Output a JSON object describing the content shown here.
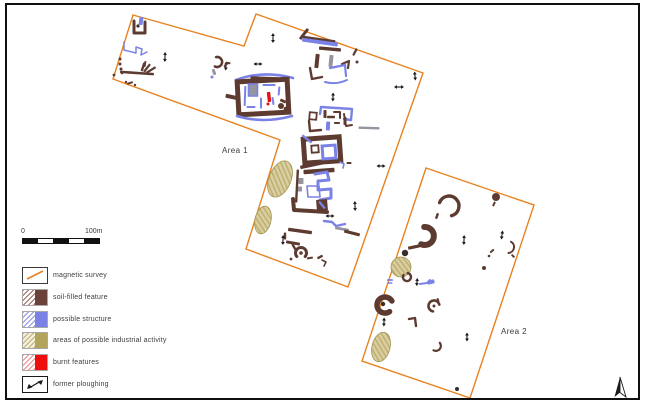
{
  "canvas": {
    "width": 646,
    "height": 407,
    "background": "#ffffff",
    "frame_color": "#0f0f0f"
  },
  "colors": {
    "orange": "#E8821E",
    "brown": "#5E3B31",
    "blue": "#7B82E6",
    "grey": "#9595A0",
    "red": "#E41111",
    "dark": "#3A2C28",
    "khaki": "#C9BB87",
    "khakiDark": "#A3924F",
    "black": "#1A1A1A",
    "text": "#3C3C3C"
  },
  "scalebar": {
    "start_label": "0",
    "end_label": "100m",
    "segments": 5
  },
  "legend": {
    "items": [
      {
        "id": "magnetic-survey",
        "label": "magnetic survey"
      },
      {
        "id": "soil-filled-feature",
        "label": "soil-filled feature"
      },
      {
        "id": "possible-structure",
        "label": "possible structure"
      },
      {
        "id": "industrial-activity",
        "label": "areas of possible industrial activity"
      },
      {
        "id": "burnt-features",
        "label": "burnt features"
      },
      {
        "id": "former-ploughing",
        "label": "former ploughing"
      }
    ]
  },
  "map": {
    "areas": [
      {
        "id": "1",
        "label": "Area 1",
        "label_x": 235,
        "label_y": 153,
        "points": "133,15 244,46 256,14 423,73 348,287 246,249 280,140 113,79"
      },
      {
        "id": "2",
        "label": "Area 2",
        "label_x": 514,
        "label_y": 334,
        "points": "426,168 534,205 470,398 362,361"
      }
    ],
    "north_arrow": {
      "x": 620,
      "y": 387
    },
    "features": [
      {
        "t": "poly",
        "p": "134,21 134,33 145,33 145,22",
        "c": "brown",
        "w": 3
      },
      {
        "t": "bar",
        "x": 141,
        "y": 21,
        "w": 4,
        "h": 8,
        "r": 8,
        "c": "blue"
      },
      {
        "t": "dot",
        "x": 138,
        "y": 26,
        "rad": 1.6,
        "c": "dark"
      },
      {
        "t": "poly",
        "p": "124,42 124,50 136,53 136,47 142,49 141,55 147,52",
        "c": "blue",
        "w": 1.5
      },
      {
        "t": "arrow",
        "x": 165,
        "y": 57,
        "l": 10,
        "r": 92
      },
      {
        "t": "dot",
        "x": 120,
        "y": 59,
        "rad": 1.5,
        "c": "brown"
      },
      {
        "t": "dot",
        "x": 120,
        "y": 64,
        "rad": 1.5,
        "c": "brown"
      },
      {
        "t": "dot",
        "x": 121,
        "y": 69,
        "rad": 1.5,
        "c": "brown"
      },
      {
        "t": "dot",
        "x": 122,
        "y": 73,
        "rad": 1.3,
        "c": "brown"
      },
      {
        "t": "bar",
        "x": 137,
        "y": 73,
        "w": 34,
        "h": 2.6,
        "r": 4,
        "c": "brown"
      },
      {
        "t": "bar",
        "x": 143,
        "y": 67,
        "w": 2.4,
        "h": 9,
        "r": 18,
        "c": "brown"
      },
      {
        "t": "bar",
        "x": 147,
        "y": 68,
        "w": 2.2,
        "h": 10,
        "r": 38,
        "c": "brown"
      },
      {
        "t": "bar",
        "x": 151,
        "y": 70,
        "w": 2.2,
        "h": 11,
        "r": 58,
        "c": "brown"
      },
      {
        "t": "bar",
        "x": 145,
        "y": 64,
        "w": 2,
        "h": 6,
        "r": 10,
        "c": "brown"
      },
      {
        "t": "dot",
        "x": 114,
        "y": 75,
        "rad": 1.4,
        "c": "brown"
      },
      {
        "t": "bar",
        "x": 130,
        "y": 83,
        "w": 6,
        "h": 2,
        "r": -18,
        "c": "brown"
      },
      {
        "t": "dot",
        "x": 135,
        "y": 85,
        "rad": 1.2,
        "c": "brown"
      },
      {
        "t": "dot",
        "x": 126,
        "y": 82,
        "rad": 1.2,
        "c": "brown"
      },
      {
        "t": "carc",
        "x": 217,
        "y": 62,
        "rad": 5,
        "a1": -100,
        "a2": 115,
        "w": 2.6,
        "c": "brown"
      },
      {
        "t": "bar",
        "x": 214,
        "y": 72,
        "w": 3,
        "h": 6,
        "r": -20,
        "c": "grey"
      },
      {
        "t": "dot",
        "x": 212,
        "y": 77,
        "rad": 1.5,
        "c": "blue"
      },
      {
        "t": "arrow",
        "x": 226,
        "y": 66,
        "l": 9,
        "r": 95
      },
      {
        "t": "arrow",
        "x": 273,
        "y": 38,
        "l": 10,
        "r": 90
      },
      {
        "t": "qarc",
        "p": [
          236,
          80,
          263,
          70,
          293,
          78
        ],
        "w": 2.6,
        "c": "blue"
      },
      {
        "t": "bar",
        "x": 264,
        "y": 79,
        "w": 27,
        "h": 4.6,
        "r": 2,
        "c": "brown"
      },
      {
        "t": "rbox",
        "x": 263,
        "y": 97,
        "w": 50,
        "h": 33,
        "r": -3,
        "sw": 5,
        "c": "brown"
      },
      {
        "t": "bar",
        "x": 232,
        "y": 97,
        "w": 13,
        "h": 4,
        "r": 12,
        "c": "brown"
      },
      {
        "t": "bar",
        "x": 253,
        "y": 90,
        "w": 9,
        "h": 12,
        "r": 0,
        "c": "grey"
      },
      {
        "t": "rbox",
        "x": 253,
        "y": 90,
        "w": 9,
        "h": 12,
        "r": 0,
        "sw": 1.6,
        "c": "blue"
      },
      {
        "t": "bar",
        "x": 245,
        "y": 96,
        "w": 2,
        "h": 20,
        "r": 2,
        "c": "blue"
      },
      {
        "t": "bar",
        "x": 261,
        "y": 103,
        "w": 2,
        "h": 11,
        "r": 0,
        "c": "blue"
      },
      {
        "t": "bar",
        "x": 269,
        "y": 85,
        "w": 13,
        "h": 2,
        "r": 0,
        "c": "blue"
      },
      {
        "t": "bar",
        "x": 279,
        "y": 91,
        "w": 2,
        "h": 9,
        "r": 5,
        "c": "blue"
      },
      {
        "t": "bar",
        "x": 273,
        "y": 101,
        "w": 2,
        "h": 8,
        "r": -8,
        "c": "blue"
      },
      {
        "t": "bar",
        "x": 251,
        "y": 107,
        "w": 9,
        "h": 2,
        "r": 0,
        "c": "blue"
      },
      {
        "t": "bar",
        "x": 269,
        "y": 97,
        "w": 3.4,
        "h": 10,
        "r": -6,
        "c": "red"
      },
      {
        "t": "dot",
        "x": 268,
        "y": 104,
        "rad": 1.5,
        "c": "red"
      },
      {
        "t": "dot",
        "x": 281,
        "y": 106,
        "rad": 3,
        "c": "brown"
      },
      {
        "t": "dot",
        "x": 286,
        "y": 109,
        "rad": 2.4,
        "c": "brown"
      },
      {
        "t": "bar",
        "x": 283,
        "y": 101,
        "w": 6,
        "h": 3,
        "r": 25,
        "c": "brown"
      },
      {
        "t": "qarc",
        "p": [
          237,
          116,
          263,
          124,
          292,
          116
        ],
        "w": 2.6,
        "c": "blue"
      },
      {
        "t": "bar",
        "x": 228,
        "y": 63,
        "w": 5,
        "h": 2,
        "r": 10,
        "c": "brown"
      },
      {
        "t": "dot",
        "x": 225,
        "y": 66,
        "rad": 1.3,
        "c": "brown"
      },
      {
        "t": "arrow",
        "x": 258,
        "y": 64,
        "l": 9,
        "r": 0
      },
      {
        "t": "arrow",
        "x": 399,
        "y": 87,
        "l": 10,
        "r": 0
      },
      {
        "t": "arrow",
        "x": 415,
        "y": 76,
        "l": 9,
        "r": 85
      },
      {
        "t": "bar",
        "x": 304,
        "y": 34,
        "w": 3,
        "h": 13,
        "r": 38,
        "c": "brown"
      },
      {
        "t": "bar",
        "x": 320,
        "y": 42,
        "w": 36,
        "h": 4.2,
        "r": 8,
        "c": "blue"
      },
      {
        "t": "bar",
        "x": 319,
        "y": 39,
        "w": 33,
        "h": 2.2,
        "r": 8,
        "c": "brown"
      },
      {
        "t": "bar",
        "x": 330,
        "y": 49,
        "w": 22,
        "h": 3.4,
        "r": 5,
        "c": "brown"
      },
      {
        "t": "bar",
        "x": 317,
        "y": 61,
        "w": 4,
        "h": 14,
        "r": 6,
        "c": "brown"
      },
      {
        "t": "bar",
        "x": 331,
        "y": 61,
        "w": 4,
        "h": 12,
        "r": 6,
        "c": "grey"
      },
      {
        "t": "poly",
        "p": "342,64 349,61 348,68",
        "c": "brown",
        "w": 2.2
      },
      {
        "t": "bar",
        "x": 355,
        "y": 52,
        "w": 2.2,
        "h": 8,
        "r": 28,
        "c": "brown"
      },
      {
        "t": "dot",
        "x": 357,
        "y": 62,
        "rad": 1.5,
        "c": "brown"
      },
      {
        "t": "poly",
        "p": "330,68 345,65 346,76",
        "c": "blue",
        "w": 2.2
      },
      {
        "t": "poly",
        "p": "310,68 312,79 322,77",
        "c": "brown",
        "w": 2.4
      },
      {
        "t": "qarc",
        "p": [
          325,
          82,
          336,
          85,
          347,
          80
        ],
        "w": 2,
        "c": "blue"
      },
      {
        "t": "arrow",
        "x": 333,
        "y": 97,
        "l": 9,
        "r": 92
      },
      {
        "t": "poly",
        "p": "320,114 321,107 352,109 351,120 344,119",
        "c": "blue",
        "w": 2.4
      },
      {
        "t": "rbox",
        "x": 313,
        "y": 116,
        "w": 7,
        "h": 7,
        "r": 5,
        "sw": 1.8,
        "c": "brown"
      },
      {
        "t": "bar",
        "x": 325,
        "y": 114,
        "w": 3,
        "h": 8,
        "r": 0,
        "c": "brown"
      },
      {
        "t": "bar",
        "x": 331,
        "y": 117,
        "w": 8,
        "h": 2.4,
        "r": 0,
        "c": "brown"
      },
      {
        "t": "poly",
        "p": "334,112 340,112 340,118",
        "c": "brown",
        "w": 2
      },
      {
        "t": "bar",
        "x": 345,
        "y": 121,
        "w": 3,
        "h": 8,
        "r": 0,
        "c": "brown"
      },
      {
        "t": "bar",
        "x": 337,
        "y": 123,
        "w": 6,
        "h": 2,
        "r": 0,
        "c": "brown"
      },
      {
        "t": "poly",
        "p": "309,121 310,131 321,130",
        "c": "brown",
        "w": 2.4
      },
      {
        "t": "bar",
        "x": 328,
        "y": 126,
        "w": 4,
        "h": 9,
        "r": 3,
        "c": "blue"
      },
      {
        "t": "poly",
        "p": "344,114 346,126 352,125",
        "c": "brown",
        "w": 2
      },
      {
        "t": "bar",
        "x": 369,
        "y": 128,
        "w": 21,
        "h": 2.4,
        "r": 2,
        "c": "grey"
      },
      {
        "t": "rbox",
        "x": 322,
        "y": 150,
        "w": 36,
        "h": 24,
        "r": -4,
        "sw": 5,
        "c": "brown"
      },
      {
        "t": "rbox",
        "x": 329,
        "y": 152,
        "w": 13,
        "h": 13,
        "r": -4,
        "sw": 3,
        "c": "blue"
      },
      {
        "t": "bar",
        "x": 307,
        "y": 139,
        "w": 2.4,
        "h": 12,
        "r": -52,
        "c": "blue"
      },
      {
        "t": "rbox",
        "x": 315,
        "y": 149,
        "w": 7,
        "h": 7,
        "r": -4,
        "sw": 1.8,
        "c": "brown"
      },
      {
        "t": "bar",
        "x": 312,
        "y": 165,
        "w": 24,
        "h": 3.4,
        "r": -12,
        "c": "brown"
      },
      {
        "t": "poly",
        "p": "340,162 344,164 343,168",
        "c": "blue",
        "w": 1.6
      },
      {
        "t": "bar",
        "x": 349,
        "y": 163,
        "w": 5,
        "h": 2,
        "r": 0,
        "c": "brown"
      },
      {
        "t": "arrow",
        "x": 381,
        "y": 166,
        "l": 9,
        "r": 0
      },
      {
        "t": "bar",
        "x": 319,
        "y": 171,
        "w": 31,
        "h": 4.4,
        "r": -4,
        "c": "brown"
      },
      {
        "t": "bar",
        "x": 297,
        "y": 186,
        "w": 2.4,
        "h": 33,
        "r": 3,
        "c": "brown"
      },
      {
        "t": "bar",
        "x": 301,
        "y": 181,
        "w": 5,
        "h": 6,
        "r": 0,
        "c": "grey"
      },
      {
        "t": "bar",
        "x": 300,
        "y": 189,
        "w": 4,
        "h": 5,
        "r": 0,
        "c": "grey"
      },
      {
        "t": "poly",
        "p": "315,174 327,172 329,180 318,181 318,190 331,189 331,198 320,200",
        "c": "blue",
        "w": 3
      },
      {
        "t": "poly",
        "p": "307,186 319,186 320,197 308,197 307,186",
        "c": "blue",
        "w": 1.6
      },
      {
        "t": "poly",
        "p": "293,199 294,210 327,212",
        "c": "brown",
        "w": 4
      },
      {
        "t": "bar",
        "x": 322,
        "y": 205,
        "w": 11,
        "h": 11,
        "r": -5,
        "c": "brown"
      },
      {
        "t": "bar",
        "x": 322,
        "y": 205,
        "w": 2.4,
        "h": 9,
        "r": -40,
        "c": "blue"
      },
      {
        "t": "arrow",
        "x": 355,
        "y": 206,
        "l": 10,
        "r": 88
      },
      {
        "t": "arrow",
        "x": 330,
        "y": 216,
        "l": 9,
        "r": 0
      },
      {
        "t": "poly",
        "p": "324,221 332,222 336,226 345,224",
        "c": "blue",
        "w": 2.4
      },
      {
        "t": "bar",
        "x": 342,
        "y": 229,
        "w": 14,
        "h": 2.8,
        "r": 10,
        "c": "grey"
      },
      {
        "t": "bar",
        "x": 352,
        "y": 233,
        "w": 16,
        "h": 3.2,
        "r": 14,
        "c": "brown"
      },
      {
        "t": "bar",
        "x": 300,
        "y": 231,
        "w": 24,
        "h": 3.4,
        "r": 8,
        "c": "brown"
      },
      {
        "t": "bar",
        "x": 293,
        "y": 243,
        "w": 14,
        "h": 3,
        "r": 10,
        "c": "brown"
      },
      {
        "t": "bar",
        "x": 285,
        "y": 236,
        "w": 2.4,
        "h": 7,
        "r": 0,
        "c": "brown"
      },
      {
        "t": "arrow",
        "x": 283,
        "y": 240,
        "l": 10,
        "r": 92
      },
      {
        "t": "carc",
        "x": 301,
        "y": 253,
        "rad": 5.5,
        "a1": 140,
        "a2": 400,
        "w": 3,
        "c": "brown"
      },
      {
        "t": "dot",
        "x": 301,
        "y": 253,
        "rad": 1.8,
        "c": "brown"
      },
      {
        "t": "bar",
        "x": 294,
        "y": 247,
        "w": 2.4,
        "h": 7,
        "r": -30,
        "c": "brown"
      },
      {
        "t": "dot",
        "x": 291,
        "y": 259,
        "rad": 1.4,
        "c": "brown"
      },
      {
        "t": "bar",
        "x": 310,
        "y": 258,
        "w": 6,
        "h": 2,
        "r": -10,
        "c": "brown"
      },
      {
        "t": "bar",
        "x": 320,
        "y": 257,
        "w": 6,
        "h": 2.4,
        "r": -28,
        "c": "brown"
      },
      {
        "t": "poly",
        "p": "322,260 326,262 324,266",
        "c": "brown",
        "w": 1.6
      },
      {
        "t": "blob",
        "x": 280,
        "y": 179,
        "rx": 11,
        "ry": 19,
        "r": 22
      },
      {
        "t": "blob",
        "x": 263,
        "y": 220,
        "rx": 8,
        "ry": 14,
        "r": 12
      },
      {
        "t": "carc",
        "x": 449,
        "y": 206,
        "rad": 10,
        "a1": -160,
        "a2": 75,
        "w": 3.4,
        "c": "brown"
      },
      {
        "t": "bar",
        "x": 437,
        "y": 216,
        "w": 2.4,
        "h": 6,
        "r": 20,
        "c": "brown"
      },
      {
        "t": "dot",
        "x": 496,
        "y": 197,
        "rad": 4,
        "c": "brown"
      },
      {
        "t": "bar",
        "x": 494,
        "y": 204,
        "w": 2,
        "h": 5,
        "r": 25,
        "c": "brown"
      },
      {
        "t": "carc",
        "x": 425,
        "y": 236,
        "rad": 9,
        "a1": -95,
        "a2": 115,
        "w": 6,
        "c": "brown"
      },
      {
        "t": "bar",
        "x": 414,
        "y": 247,
        "w": 12,
        "h": 3.2,
        "r": -12,
        "c": "brown"
      },
      {
        "t": "dot",
        "x": 405,
        "y": 253,
        "rad": 3.2,
        "c": "dark"
      },
      {
        "t": "blob",
        "x": 401,
        "y": 267,
        "rx": 10,
        "ry": 10,
        "r": 8
      },
      {
        "t": "bar",
        "x": 390,
        "y": 280,
        "w": 6,
        "h": 1.8,
        "r": 0,
        "c": "blue"
      },
      {
        "t": "bar",
        "x": 390,
        "y": 283,
        "w": 5,
        "h": 1.6,
        "r": 0,
        "c": "blue"
      },
      {
        "t": "carc",
        "x": 407,
        "y": 277,
        "rad": 4,
        "a1": -80,
        "a2": 210,
        "w": 2.4,
        "c": "brown"
      },
      {
        "t": "arrow",
        "x": 417,
        "y": 282,
        "l": 8,
        "r": 95
      },
      {
        "t": "poly",
        "p": "420,284 427,283 430,280",
        "c": "blue",
        "w": 2
      },
      {
        "t": "bar",
        "x": 431,
        "y": 282,
        "w": 7,
        "h": 4,
        "r": -15,
        "c": "blue"
      },
      {
        "t": "arrow",
        "x": 464,
        "y": 240,
        "l": 10,
        "r": 92
      },
      {
        "t": "arrow",
        "x": 502,
        "y": 235,
        "l": 9,
        "r": 98
      },
      {
        "t": "bar",
        "x": 492,
        "y": 251,
        "w": 5,
        "h": 2,
        "r": -40,
        "c": "brown"
      },
      {
        "t": "dot",
        "x": 489,
        "y": 256,
        "rad": 1.3,
        "c": "brown"
      },
      {
        "t": "carc",
        "x": 508,
        "y": 247,
        "rad": 6,
        "a1": -60,
        "a2": 85,
        "w": 2,
        "c": "brown"
      },
      {
        "t": "bar",
        "x": 513,
        "y": 256,
        "w": 4,
        "h": 2,
        "r": 45,
        "c": "brown"
      },
      {
        "t": "dot",
        "x": 484,
        "y": 268,
        "rad": 2,
        "c": "brown"
      },
      {
        "t": "carc",
        "x": 385,
        "y": 305,
        "rad": 8,
        "a1": 55,
        "a2": 330,
        "w": 5.5,
        "c": "brown"
      },
      {
        "t": "dot",
        "x": 383,
        "y": 304,
        "rad": 2.2,
        "c": "dark"
      },
      {
        "t": "arrow",
        "x": 384,
        "y": 322,
        "l": 9,
        "r": 92
      },
      {
        "t": "poly",
        "p": "409,319 415,318 416,326",
        "c": "brown",
        "w": 2.4
      },
      {
        "t": "carc",
        "x": 434,
        "y": 306,
        "rad": 5.5,
        "a1": 100,
        "a2": 345,
        "w": 2.6,
        "c": "brown"
      },
      {
        "t": "dot",
        "x": 434,
        "y": 306,
        "rad": 1.5,
        "c": "brown"
      },
      {
        "t": "bar",
        "x": 438,
        "y": 300,
        "w": 2,
        "h": 4,
        "r": -20,
        "c": "brown"
      },
      {
        "t": "blob",
        "x": 381,
        "y": 347,
        "rx": 9,
        "ry": 15,
        "r": 14
      },
      {
        "t": "carc",
        "x": 436,
        "y": 346,
        "rad": 5,
        "a1": -40,
        "a2": 120,
        "w": 2.2,
        "c": "brown"
      },
      {
        "t": "arrow",
        "x": 467,
        "y": 337,
        "l": 9,
        "r": 90
      },
      {
        "t": "dot",
        "x": 457,
        "y": 389,
        "rad": 2,
        "c": "dark"
      }
    ]
  }
}
